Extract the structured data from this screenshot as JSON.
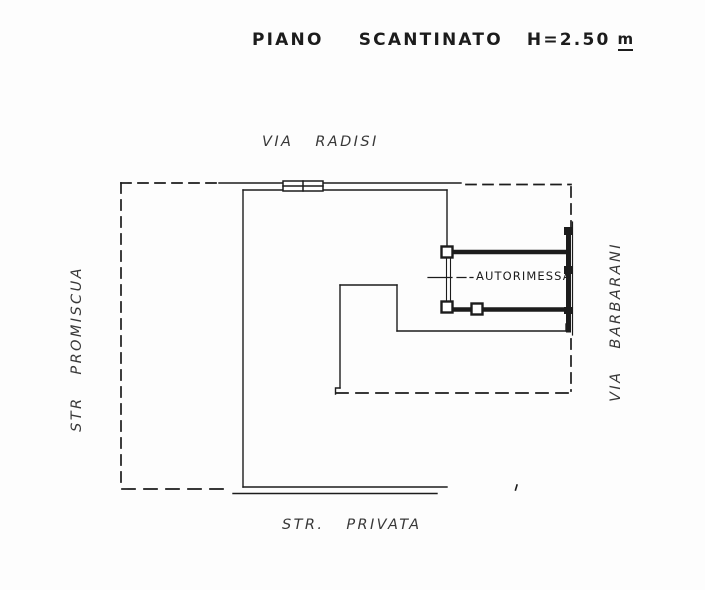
{
  "title": {
    "name": "PIANO SCANTINATO",
    "height": "H=2.50",
    "unit": "m"
  },
  "streets": {
    "top": "VIA RADISI",
    "left": "STR PROMISCUA",
    "right": "VIA BARBARANI",
    "bottom": "STR. PRIVATA"
  },
  "rooms": {
    "garage": "AUTORIMESSA"
  },
  "colors": {
    "ink": "#1c1c1c",
    "paper": "#fdfdfd"
  }
}
